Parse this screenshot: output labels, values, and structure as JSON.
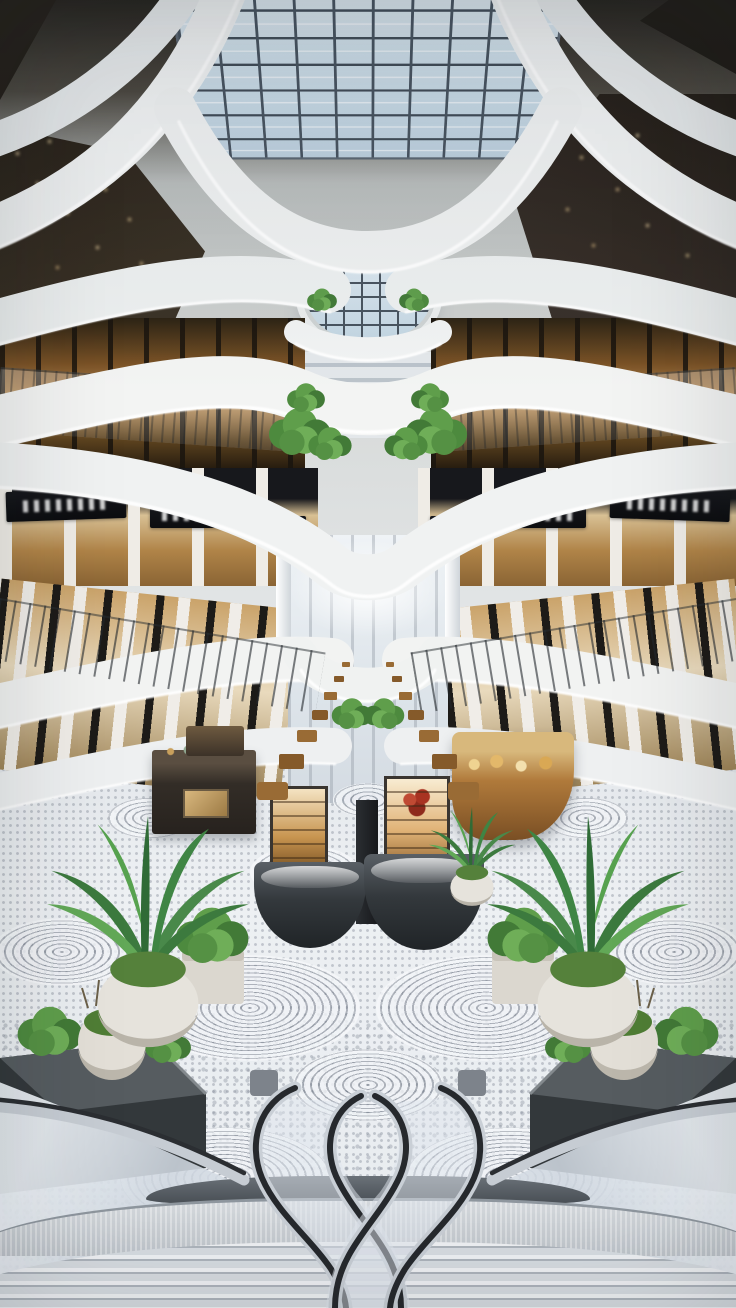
{
  "page": {
    "kind": "photograph",
    "subject": "Modern luxury shopping mall atrium, symmetrical interior view"
  },
  "scene": {
    "overall": {
      "label": "Multi-level shopping mall atrium viewed from an upper staircase landing"
    },
    "skylight": {
      "label": "Rectangular glass-grid skylight with steel mullions",
      "glass": "#cfe0ea",
      "mullions": "#3f4a55"
    },
    "ceiling_bands": {
      "label": "Sculpted curved white ceiling and balcony bands with LED cove lighting",
      "color": "#f2f3f2",
      "led": "#ffffff"
    },
    "dark_ceiling": {
      "label": "Recessed dark ceiling areas with warm downlight spots",
      "color": "#241e16",
      "spotlight": "#f2d9a6"
    },
    "storefronts": {
      "label": "Warm-lit storefronts with dark frames and glass balustrades on every level",
      "glow": "#c09157"
    },
    "store_signs": {
      "label": "Black storefront sign band with blurred white lettering (illegible)",
      "count_visible": 8,
      "background": "#101216"
    },
    "corridor": {
      "label": "Bright central corridor receding to a luminous far end, lined with columns"
    },
    "cafe_tables": {
      "label": "Rows of warm wooden cafe tables and chairs along the central corridor",
      "wood": "#996b35"
    },
    "kiosks": {
      "label": "Central retail kiosks: dark rounded display counters, brass-lit cabinets, red floral arrangement and a curved wooden stall",
      "count": 4,
      "wood": "#9c6a33",
      "counter": "#33383c",
      "floral": "#a83322"
    },
    "floor": {
      "label": "Light mosaic terrazzo floor with concentric circular swirl medallions",
      "base": "#e9edf1",
      "pattern": "#6c7480",
      "swirl_count_visible": 13
    },
    "plants": {
      "label": "Tropical palms in round white pots, shrubs in white cube planters and dark stone planter boxes",
      "palm_count": 2,
      "foliage": "#4f944a",
      "pot": "#e4e1da",
      "planter_box": "#34383a"
    },
    "escalators": {
      "label": "Twin escalators with S-curved chrome balustrades and black handrails descending to the lower court",
      "count": 2,
      "handrail": "#26292d",
      "metal": "#c9cfd6"
    },
    "staircase": {
      "label": "Wide curved staircase with ribbed treads in the immediate foreground",
      "tread": "#d8dde2"
    },
    "balconies": {
      "label": "Stacked balcony levels with slim dark railing posts and glass panels",
      "levels_visible": 4
    }
  }
}
